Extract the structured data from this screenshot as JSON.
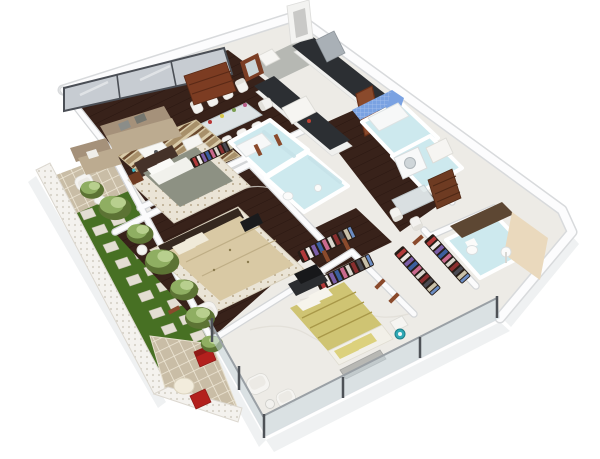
{
  "meta": {
    "title": "3D isometric floor plan render of a three-bedroom apartment",
    "view": "aerial cutaway dollhouse render",
    "background": "#ffffff",
    "no_visible_text": true
  },
  "colors": {
    "marble": "#edebe6",
    "wood_floor": "#38221a",
    "grass": "#477023",
    "patio_tile": "#c9bda6",
    "pale_blue": "#cde9ee",
    "mosaic_blue": "#7aa2e2",
    "sofa_tan": "#bcab90",
    "sofa_back": "#a5917a",
    "sideboard_brown": "#7c3c22",
    "counter_dark": "#2c2f33",
    "steel": "#a9b0b6",
    "door_wood": "#8a4a2c",
    "bed_gray": "#8d9183",
    "bed_beige": "#d9c9a4",
    "bed_yellow": "#cfc473",
    "red_chair": "#b3201d",
    "chest_brown": "#6e3b22",
    "beige_wall": "#ead9bd",
    "concrete": "#b6b8b3",
    "window_glass": "#c7ccd2",
    "balcony_glass": "rgba(203,216,224,0.55)",
    "vanity_brown": "#5d4733",
    "tv_dark": "#17181a",
    "wall_white": "#fbfbfc",
    "rug_cream": "#eae4d6"
  },
  "scene": {
    "rooms": [
      {
        "name": "living-room",
        "floor": "dark hardwood",
        "items": [
          "tan three-seat sofa",
          "tan loveseat",
          "striped area rug",
          "white coffee table",
          "dark wood sideboard",
          "white lounge chair",
          "floor-to-ceiling gray glass windows"
        ]
      },
      {
        "name": "dining-area",
        "floor": "dark hardwood",
        "items": [
          "glass dining table",
          "eight white high-back chairs",
          "flower centerpieces"
        ]
      },
      {
        "name": "kitchen",
        "floor": "white marble",
        "items": [
          "dark L-shaped counters",
          "stainless refrigerator",
          "concrete feature wall",
          "wood framed window",
          "wood entry door",
          "white chimney hood"
        ]
      },
      {
        "name": "bedroom-1",
        "floor": "white marble",
        "items": [
          "gray double bed",
          "white pillows",
          "dark headboard wall",
          "brown nightstand",
          "open clothes rack",
          "pale dotted rug"
        ]
      },
      {
        "name": "bathroom-1",
        "floor": "pale blue tile",
        "items": [
          "bathtub",
          "glass shower screen"
        ]
      },
      {
        "name": "bathroom-2",
        "floor": "pale blue tile",
        "items": [
          "glass shower screen",
          "toilet",
          "sink"
        ]
      },
      {
        "name": "blue-mosaic-bathroom",
        "walls": "bright blue mosaic tile",
        "items": [
          "bathtub"
        ]
      },
      {
        "name": "utility-study",
        "floor": "pale blue tile",
        "items": [
          "washing machine",
          "white cabinet",
          "glass desk",
          "two white chairs",
          "brown chest of drawers"
        ]
      },
      {
        "name": "bedroom-2",
        "floor": "dark hardwood",
        "items": [
          "beige patterned double bed",
          "cream dotted rug",
          "wall tv panel",
          "tv on stand",
          "white armchair",
          "round side table"
        ]
      },
      {
        "name": "dressing-corridor",
        "floor": "dark hardwood",
        "items": [
          "two open wardrobes with hanging clothes"
        ]
      },
      {
        "name": "master-bedroom",
        "floor": "white marble",
        "items": [
          "yellow-green patterned double bed",
          "white mattress pillows",
          "gray bench",
          "two white armchairs",
          "floor lamp",
          "tv on stand",
          "white nightstand",
          "teal stool",
          "glass balustrade"
        ]
      },
      {
        "name": "walk-in-closet",
        "floor": "white marble",
        "items": [
          "two hanging clothes racks"
        ]
      },
      {
        "name": "master-bathroom",
        "floor": "pale blue tile",
        "items": [
          "toilet",
          "pedestal sink",
          "dark brown vanity counter",
          "beige accent wall"
        ]
      },
      {
        "name": "garden-terrace",
        "items": [
          "green lawn",
          "white stepping stones",
          "shrubs and small trees",
          "white perforated lattice fence",
          "white wicker chair",
          "round white patio table",
          "two red chairs",
          "tan floor tiles"
        ]
      }
    ]
  }
}
